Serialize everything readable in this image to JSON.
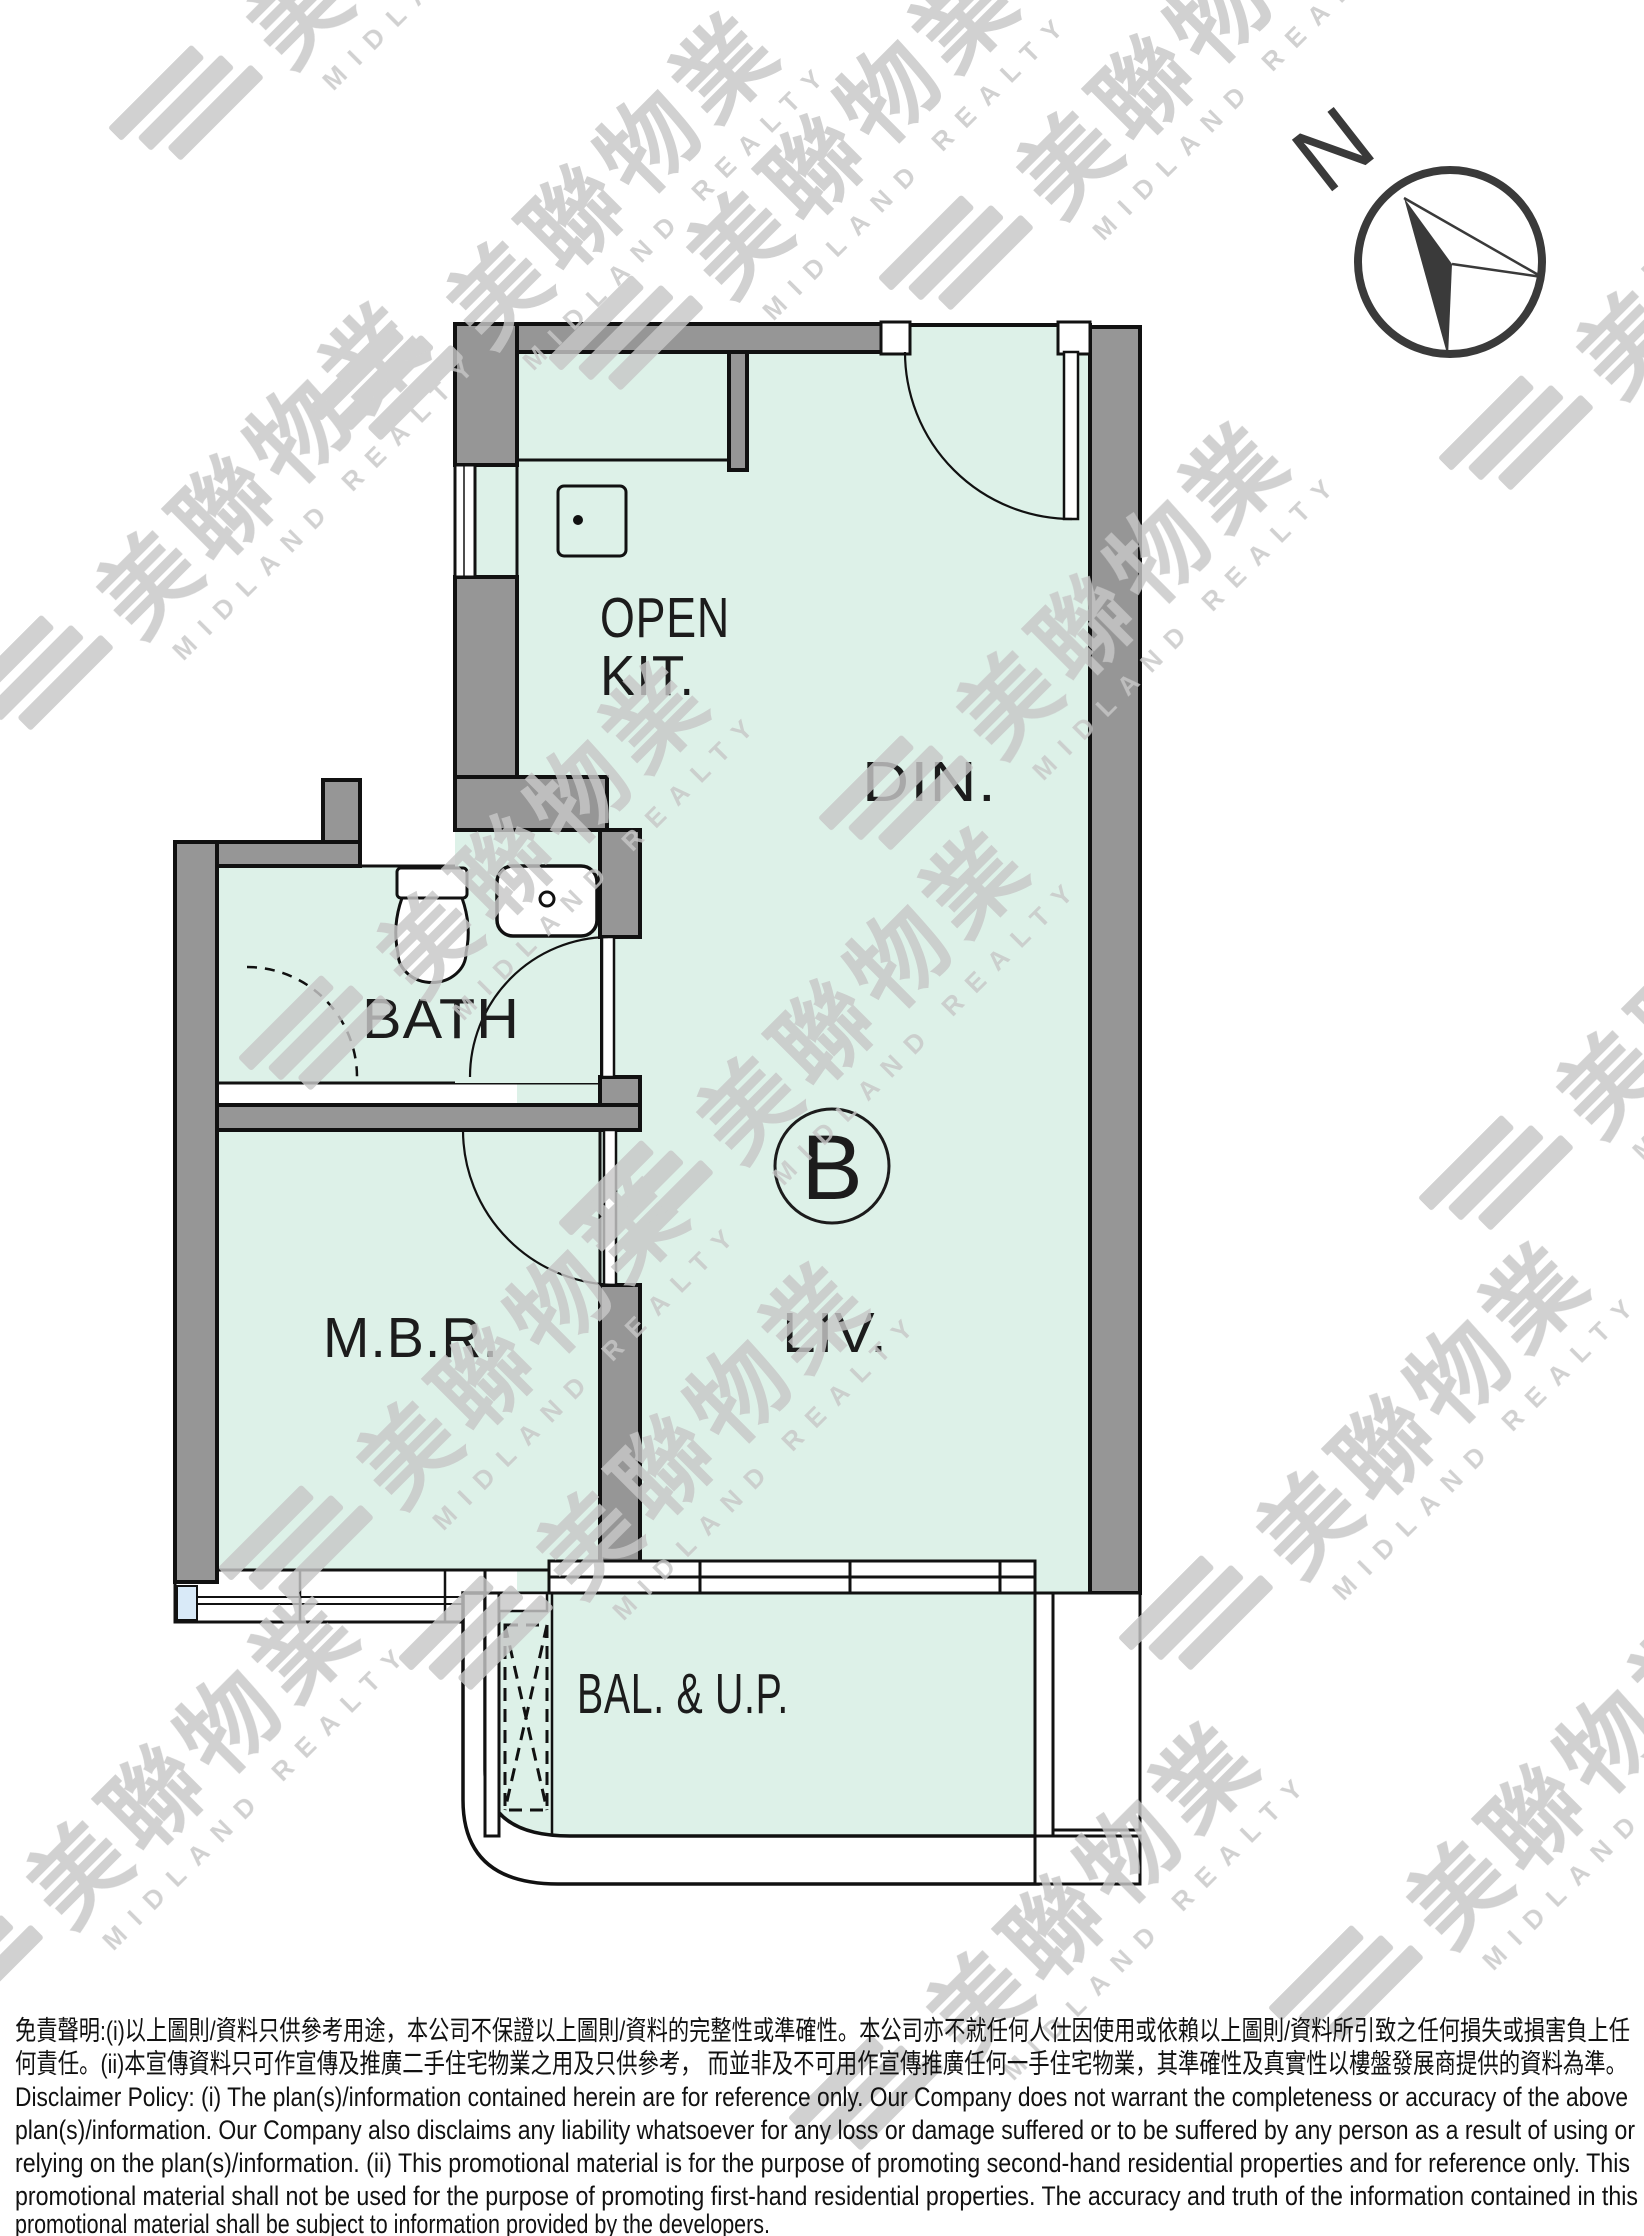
{
  "colors": {
    "floor_fill": "#ddf1e8",
    "wall_fill": "#969696",
    "glass_fill": "#d9eaf8",
    "watermark_color": "#c7c7c7",
    "line_color": "#111111"
  },
  "compass": {
    "north_label": "N"
  },
  "watermark": {
    "cjk": "美聯物業",
    "en": "MIDLAND REALTY"
  },
  "plan": {
    "unit_label": "B",
    "rooms": {
      "open_kitchen_line1": "OPEN",
      "open_kitchen_line2": "KIT.",
      "dining": "DIN.",
      "bath": "BATH",
      "living": "LIV.",
      "master_bedroom": "M.B.R.",
      "balcony": "BAL. & U.P."
    }
  },
  "disclaimer": {
    "lines": [
      "免責聲明:(i)以上圖則/資料只供參考用途，本公司不保證以上圖則/資料的完整性或準確性。本公司亦不就任何人仕因使用或依賴以上圖則/資料所引致之任何損失或損害負上任",
      "何責任。(ii)本宣傳資料只可作宣傳及推廣二手住宅物業之用及只供參考， 而並非及不可用作宣傳推廣任何一手住宅物業，其準確性及真實性以樓盤發展商提供的資料為準。",
      "Disclaimer Policy: (i) The plan(s)/information contained herein are for reference only. Our Company does not warrant the completeness or accuracy of the above",
      "plan(s)/information. Our Company also disclaims any liability whatsoever for any loss or damage suffered or to be suffered by any person as a result of using or",
      "relying on the plan(s)/information. (ii) This promotional material is for the purpose of promoting second-hand residential properties and for reference only. This",
      "promotional material shall not be used for the purpose of promoting first-hand residential properties. The accuracy and truth of the information contained in this",
      "promotional material shall be subject to information provided by the developers."
    ]
  }
}
